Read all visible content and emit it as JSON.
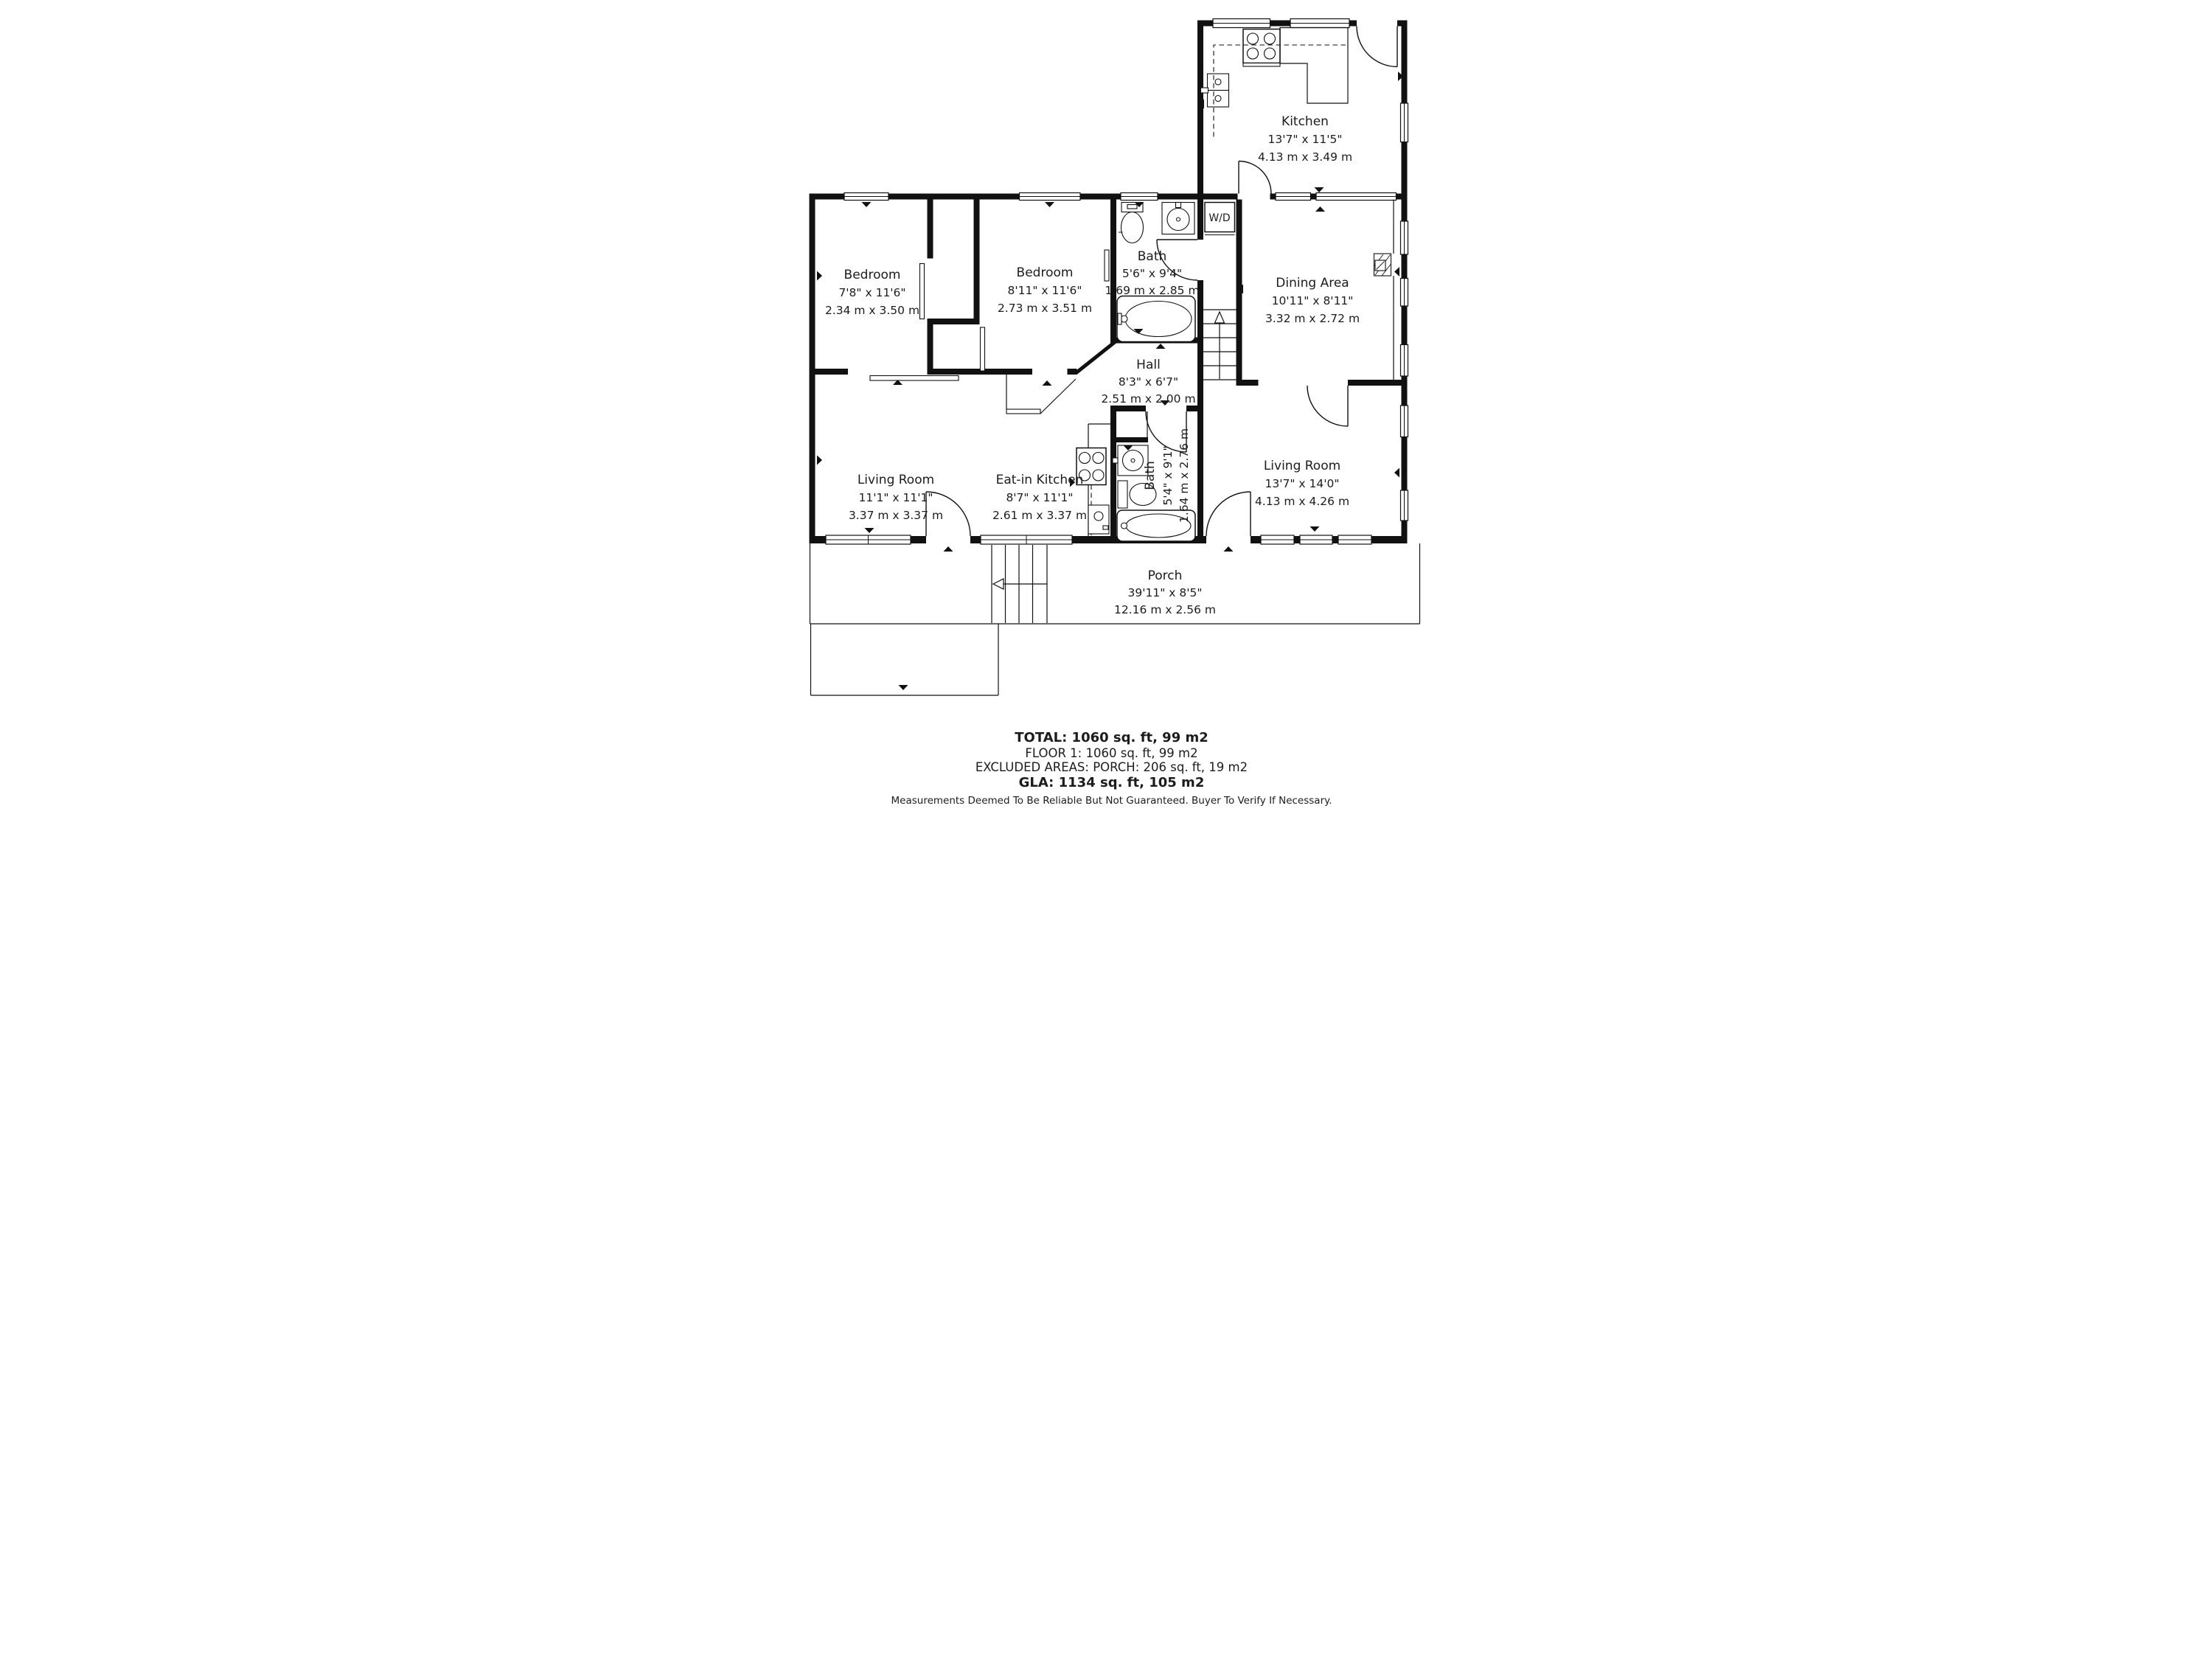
{
  "rooms": {
    "kitchen": {
      "name": "Kitchen",
      "imperial": "13'7\" x 11'5\"",
      "metric": "4.13 m x 3.49 m"
    },
    "dining": {
      "name": "Dining Area",
      "imperial": "10'11\" x 8'11\"",
      "metric": "3.32 m x 2.72 m"
    },
    "bedroom1": {
      "name": "Bedroom",
      "imperial": "7'8\" x 11'6\"",
      "metric": "2.34 m x 3.50 m"
    },
    "bedroom2": {
      "name": "Bedroom",
      "imperial": "8'11\" x 11'6\"",
      "metric": "2.73 m x 3.51 m"
    },
    "bath1": {
      "name": "Bath",
      "imperial": "5'6\" x 9'4\"",
      "metric": "1.69 m x 2.85 m"
    },
    "hall": {
      "name": "Hall",
      "imperial": "8'3\" x 6'7\"",
      "metric": "2.51 m x 2.00 m"
    },
    "living1": {
      "name": "Living Room",
      "imperial": "11'1\" x 11'1\"",
      "metric": "3.37 m x 3.37 m"
    },
    "eat_in": {
      "name": "Eat-in Kitchen",
      "imperial": "8'7\" x 11'1\"",
      "metric": "2.61 m x 3.37 m"
    },
    "bath2": {
      "name": "Bath",
      "imperial": "5'4\" x 9'1\"",
      "metric": "1.64 m x 2.76 m"
    },
    "living2": {
      "name": "Living Room",
      "imperial": "13'7\" x 14'0\"",
      "metric": "4.13 m x 4.26 m"
    },
    "porch": {
      "name": "Porch",
      "imperial": "39'11\" x 8'5\"",
      "metric": "12.16 m x 2.56 m"
    }
  },
  "labels": {
    "washer_dryer": "W/D"
  },
  "summary": {
    "total": "TOTAL: 1060 sq. ft, 99 m2",
    "floor1": "FLOOR 1: 1060 sq. ft, 99 m2",
    "excluded": "EXCLUDED AREAS: PORCH: 206 sq. ft, 19 m2",
    "gla": "GLA: 1134 sq. ft, 105 m2",
    "disclaimer": "Measurements Deemed To Be Reliable But Not Guaranteed. Buyer To Verify If Necessary."
  },
  "colors": {
    "walls": "#111111",
    "background": "#ffffff",
    "text": "#1c1c1c"
  }
}
